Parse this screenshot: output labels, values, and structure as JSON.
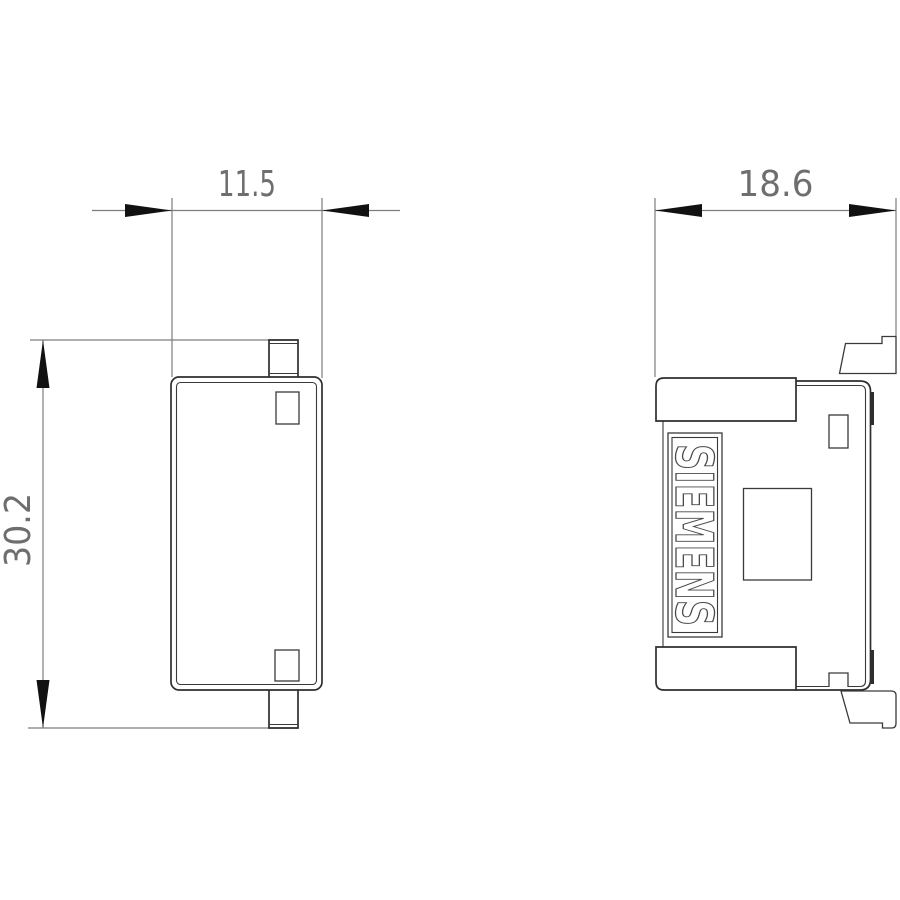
{
  "drawing": {
    "type": "technical-dimension-drawing",
    "brand": "SIEMENS",
    "views": {
      "front": {
        "name": "front-view",
        "width_label": "11.5",
        "height_label": "30.2"
      },
      "side": {
        "name": "side-view",
        "width_label": "18.6",
        "brand_label": "SIEMENS"
      }
    },
    "dimensions": [
      {
        "value": 11.5,
        "label": "11.5",
        "orientation": "horizontal",
        "view": "front"
      },
      {
        "value": 30.2,
        "label": "30.2",
        "orientation": "vertical",
        "view": "front"
      },
      {
        "value": 18.6,
        "label": "18.6",
        "orientation": "horizontal",
        "view": "side"
      }
    ],
    "colors": {
      "background": "#ffffff",
      "object_line": "#2e2e2e",
      "thin_line": "#3a3a3a",
      "dimension_line": "#7d7d7d",
      "dimension_text": "#6e6e6e",
      "arrow_fill": "#111111",
      "brand_outline": "#4a4a4a"
    }
  }
}
